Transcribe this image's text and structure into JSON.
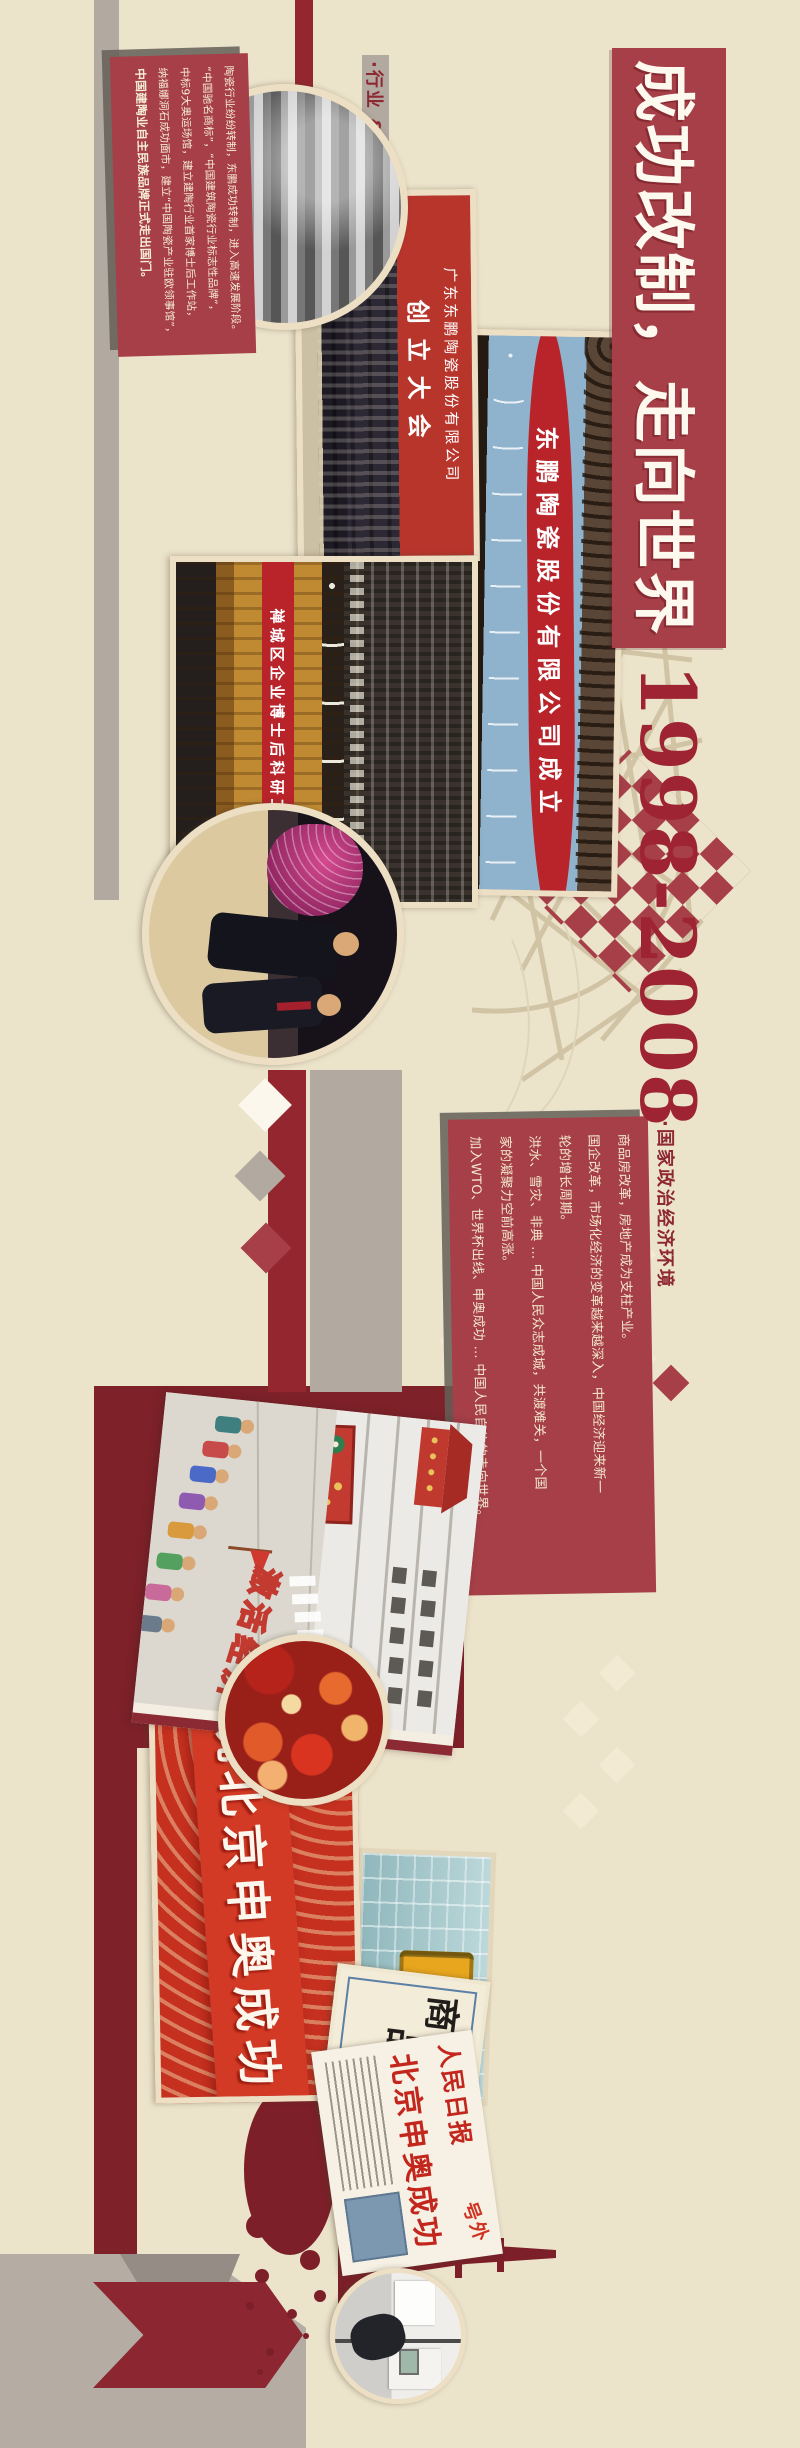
{
  "colors": {
    "background_beige": "#ece3cb",
    "accent_red": "#a63f48",
    "deep_maroon": "#7e2129",
    "banner_red": "#b8242a",
    "date_red": "#9e2433",
    "warm_gray": "#b2a9a1",
    "cream_text": "#f3e8cd"
  },
  "title": {
    "text": "成功改制，走向世界",
    "years": "1998-2008"
  },
  "sections": {
    "industry": {
      "heading": "·行业 & 东鹏发展",
      "lines": [
        "陶瓷行业纷纷转制，东鹏成功转制，进入高速发展阶段。",
        "“中国驰名商标”，“中国建筑陶瓷行业标志性品牌”，",
        "中标9大奥运场馆，建立建陶行业首家博士后工作站，",
        "纳福娜洞石成功面市，建立“中国陶瓷产业驻欧领事馆”，",
        "中国建陶业自主民族品牌正式走出国门。"
      ]
    },
    "national": {
      "heading": "·国家政治经济环境",
      "lines": [
        "商品房改革，房地产成为支柱产业。",
        "国企改革，市场化经济的变革越来越深入，中国经济迎来新一",
        "轮的增长周期。",
        "洪水、雪灾、非典 … 中国人民众志成城，共渡难关，一个国",
        "家的凝聚力空前高涨。",
        "加入WTO、世界杯出线、申奥成功 … 中国人民自信的走向世界。"
      ]
    }
  },
  "photos": {
    "founding": {
      "banner_company": "广东东鹏陶瓷股份有限公司",
      "banner_event": "创立大会"
    },
    "ceremony": {
      "banner": "东鹏陶瓷股份有限公司成立"
    },
    "workstation": {
      "banner": "禅城区企业博士后科研工作站"
    },
    "olympic": {
      "banner": "祝北京申奥成功"
    },
    "hotword_card": {
      "word": "商品房",
      "chars": [
        "商",
        "品",
        "房"
      ]
    },
    "newspaper": {
      "masthead": "人民日报",
      "extra": "号外",
      "headline": "北京申奥成功"
    },
    "cartoon": {
      "slogan": "激活经济"
    }
  }
}
